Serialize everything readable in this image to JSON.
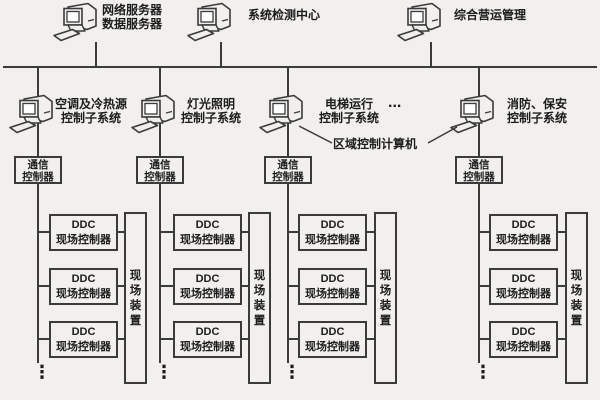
{
  "colors": {
    "background": "#f2f0ed",
    "line": "#3b3b3b",
    "text": "#1c1c1c"
  },
  "management_workstations": [
    {
      "label_line1": "网络服务器",
      "label_line2": "数据服务器"
    },
    {
      "label_line1": "系统检测中心",
      "label_line2": ""
    },
    {
      "label_line1": "综合营运管理",
      "label_line2": ""
    }
  ],
  "area_control_computer_label": "区域控制计算机",
  "row2_ellipsis": "...",
  "columns": [
    {
      "subsystem_line1": "空调及冷热源",
      "subsystem_line2": "控制子系统",
      "comm_line1": "通信",
      "comm_line2": "控制器",
      "ddc": [
        {
          "line1": "DDC",
          "line2": "现场控制器"
        },
        {
          "line1": "DDC",
          "line2": "现场控制器"
        },
        {
          "line1": "DDC",
          "line2": "现场控制器"
        }
      ],
      "field_device": {
        "char1": "现",
        "char2": "场",
        "char3": "装",
        "char4": "置"
      },
      "continuation": "⋮"
    },
    {
      "subsystem_line1": "灯光照明",
      "subsystem_line2": "控制子系统",
      "comm_line1": "通信",
      "comm_line2": "控制器",
      "ddc": [
        {
          "line1": "DDC",
          "line2": "现场控制器"
        },
        {
          "line1": "DDC",
          "line2": "现场控制器"
        },
        {
          "line1": "DDC",
          "line2": "现场控制器"
        }
      ],
      "field_device": {
        "char1": "现",
        "char2": "场",
        "char3": "装",
        "char4": "置"
      },
      "continuation": "⋮"
    },
    {
      "subsystem_line1": "电梯运行",
      "subsystem_line2": "控制子系统",
      "comm_line1": "通信",
      "comm_line2": "控制器",
      "ddc": [
        {
          "line1": "DDC",
          "line2": "现场控制器"
        },
        {
          "line1": "DDC",
          "line2": "现场控制器"
        },
        {
          "line1": "DDC",
          "line2": "现场控制器"
        }
      ],
      "field_device": {
        "char1": "现",
        "char2": "场",
        "char3": "装",
        "char4": "置"
      },
      "continuation": "⋮"
    },
    {
      "subsystem_line1": "消防、保安",
      "subsystem_line2": "控制子系统",
      "comm_line1": "通信",
      "comm_line2": "控制器",
      "ddc": [
        {
          "line1": "DDC",
          "line2": "现场控制器"
        },
        {
          "line1": "DDC",
          "line2": "现场控制器"
        },
        {
          "line1": "DDC",
          "line2": "现场控制器"
        }
      ],
      "field_device": {
        "char1": "现",
        "char2": "场",
        "char3": "装",
        "char4": "置"
      },
      "continuation": "⋮"
    }
  ]
}
